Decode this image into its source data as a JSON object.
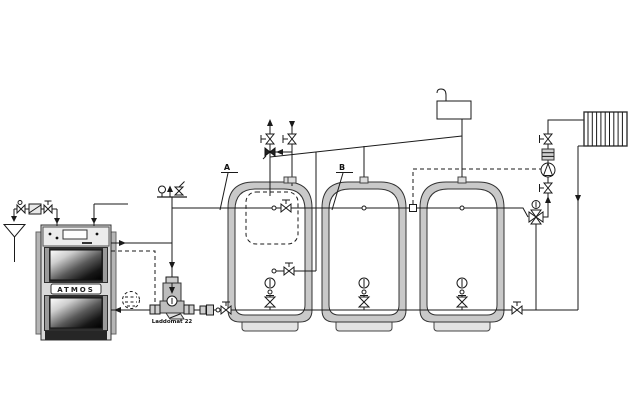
{
  "diagram_type": "heating-system-hydraulic-schematic",
  "labels": {
    "tank_a": "A",
    "tank_b": "B",
    "laddomat": "Laddomat 22",
    "boiler_brand": "ATMOS"
  },
  "colors": {
    "background": "#ffffff",
    "line": "#1a1a1a",
    "tank_insulation": "#c9c9c9",
    "tank_interior": "#ffffff",
    "boiler_body": "#d9d9d9",
    "boiler_door": "#2f2f2f",
    "fitting_gray": "#cfcfcf"
  },
  "components": [
    "wood-gasification-boiler",
    "atmos-nameplate",
    "cold-water-inlet-with-funnel-drain",
    "check-valve",
    "strainer-filter",
    "shut-off-valve",
    "boiler-safety-group-pressure-gauge-vent-safety-valve",
    "laddomat-22-loading-unit",
    "optional-pump-dashed",
    "dashed-bypass-line",
    "buffer-tank-a-with-internal-dhw-tank",
    "buffer-tank-b",
    "buffer-tank-c",
    "tank-thermometers",
    "tank-drain-valves",
    "open-expansion-vessel",
    "vent-expansion-line",
    "alternative-connection-dashed",
    "four-way-mixing-valve-with-actuator",
    "circulation-pump",
    "pump-isolation-valves",
    "filter-fitting",
    "radiator",
    "flow-direction-arrows"
  ]
}
